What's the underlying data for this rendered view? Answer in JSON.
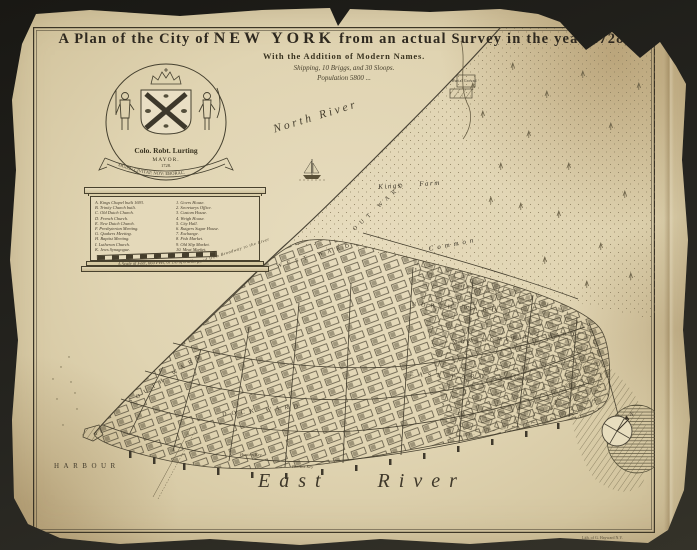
{
  "title": {
    "prefix": "A Plan of the City of",
    "city": "NEW YORK",
    "suffix": "from an actual Survey in the year 1728,",
    "subtitle": "With the Addition of Modern Names.",
    "shipping": "Shipping, 10 Briggs, and 30 Sloops.",
    "population": "Population 5800 ..."
  },
  "cartouche": {
    "name": "Colo. Robt. Lurting",
    "office": "MAYOR.",
    "year": "1728.",
    "motto": "SIGILL: CIVITAT: NOV: EBORAC."
  },
  "reference": {
    "left": [
      "A. Kings Chapel built 1693.",
      "B. Trinity Church built.",
      "C. Old Dutch Church.",
      "D. French Church.",
      "E. New Dutch Church.",
      "F. Presbyterian Meeting.",
      "G. Quakers Meeting.",
      "H. Baptist Meeting.",
      "I. Lutheran Church.",
      "K. Jews Synagogue."
    ],
    "right": [
      "1. Govrs House.",
      "2. Secretarys Office.",
      "3. Custom House.",
      "4. Weigh House.",
      "5. City Hall.",
      "6. Rutgers Sugar House.",
      "7. Exchange.",
      "8. Fish Market.",
      "9. Old Slip Market.",
      "10. Meat Market.",
      "11. Fly Market."
    ]
  },
  "scale_caption": "A Scale of Feet, 660 Feet, or 1/8 of a Mile.",
  "labels": {
    "north_river": "North River",
    "kings_farm": "Kings Farm",
    "common": "Common",
    "burial_ground": "Burial Ground",
    "beekmans_swamp": "Beekmans Swamp",
    "hunters_key": "Hunters Key",
    "burnets_key": "Burnets Key",
    "east_river": "East River",
    "harbour": "HARBOUR",
    "compass_north": "N"
  },
  "wards": [
    {
      "id": "out",
      "label": "OUT WARD"
    },
    {
      "id": "west",
      "label": "WEST WARD"
    },
    {
      "id": "north",
      "label": "NORTH WARD"
    },
    {
      "id": "east",
      "label": "EAST WARD"
    },
    {
      "id": "dock",
      "label": "DOCK WARD"
    },
    {
      "id": "south",
      "label": "SOUTH WARD"
    },
    {
      "id": "montgomerie",
      "label": "MONTGOMERIE'S WARD"
    }
  ],
  "roads": {
    "post_road": "Post Road to Boston",
    "broadway_road": "Road from Broadway to the River",
    "bowery_road": "Road to the Bowery"
  },
  "imprint": "Lith. of G. Hayward N.Y.",
  "colors": {
    "paper": "#e0d4b4",
    "ink": "#362f23",
    "background": "#23221e"
  }
}
